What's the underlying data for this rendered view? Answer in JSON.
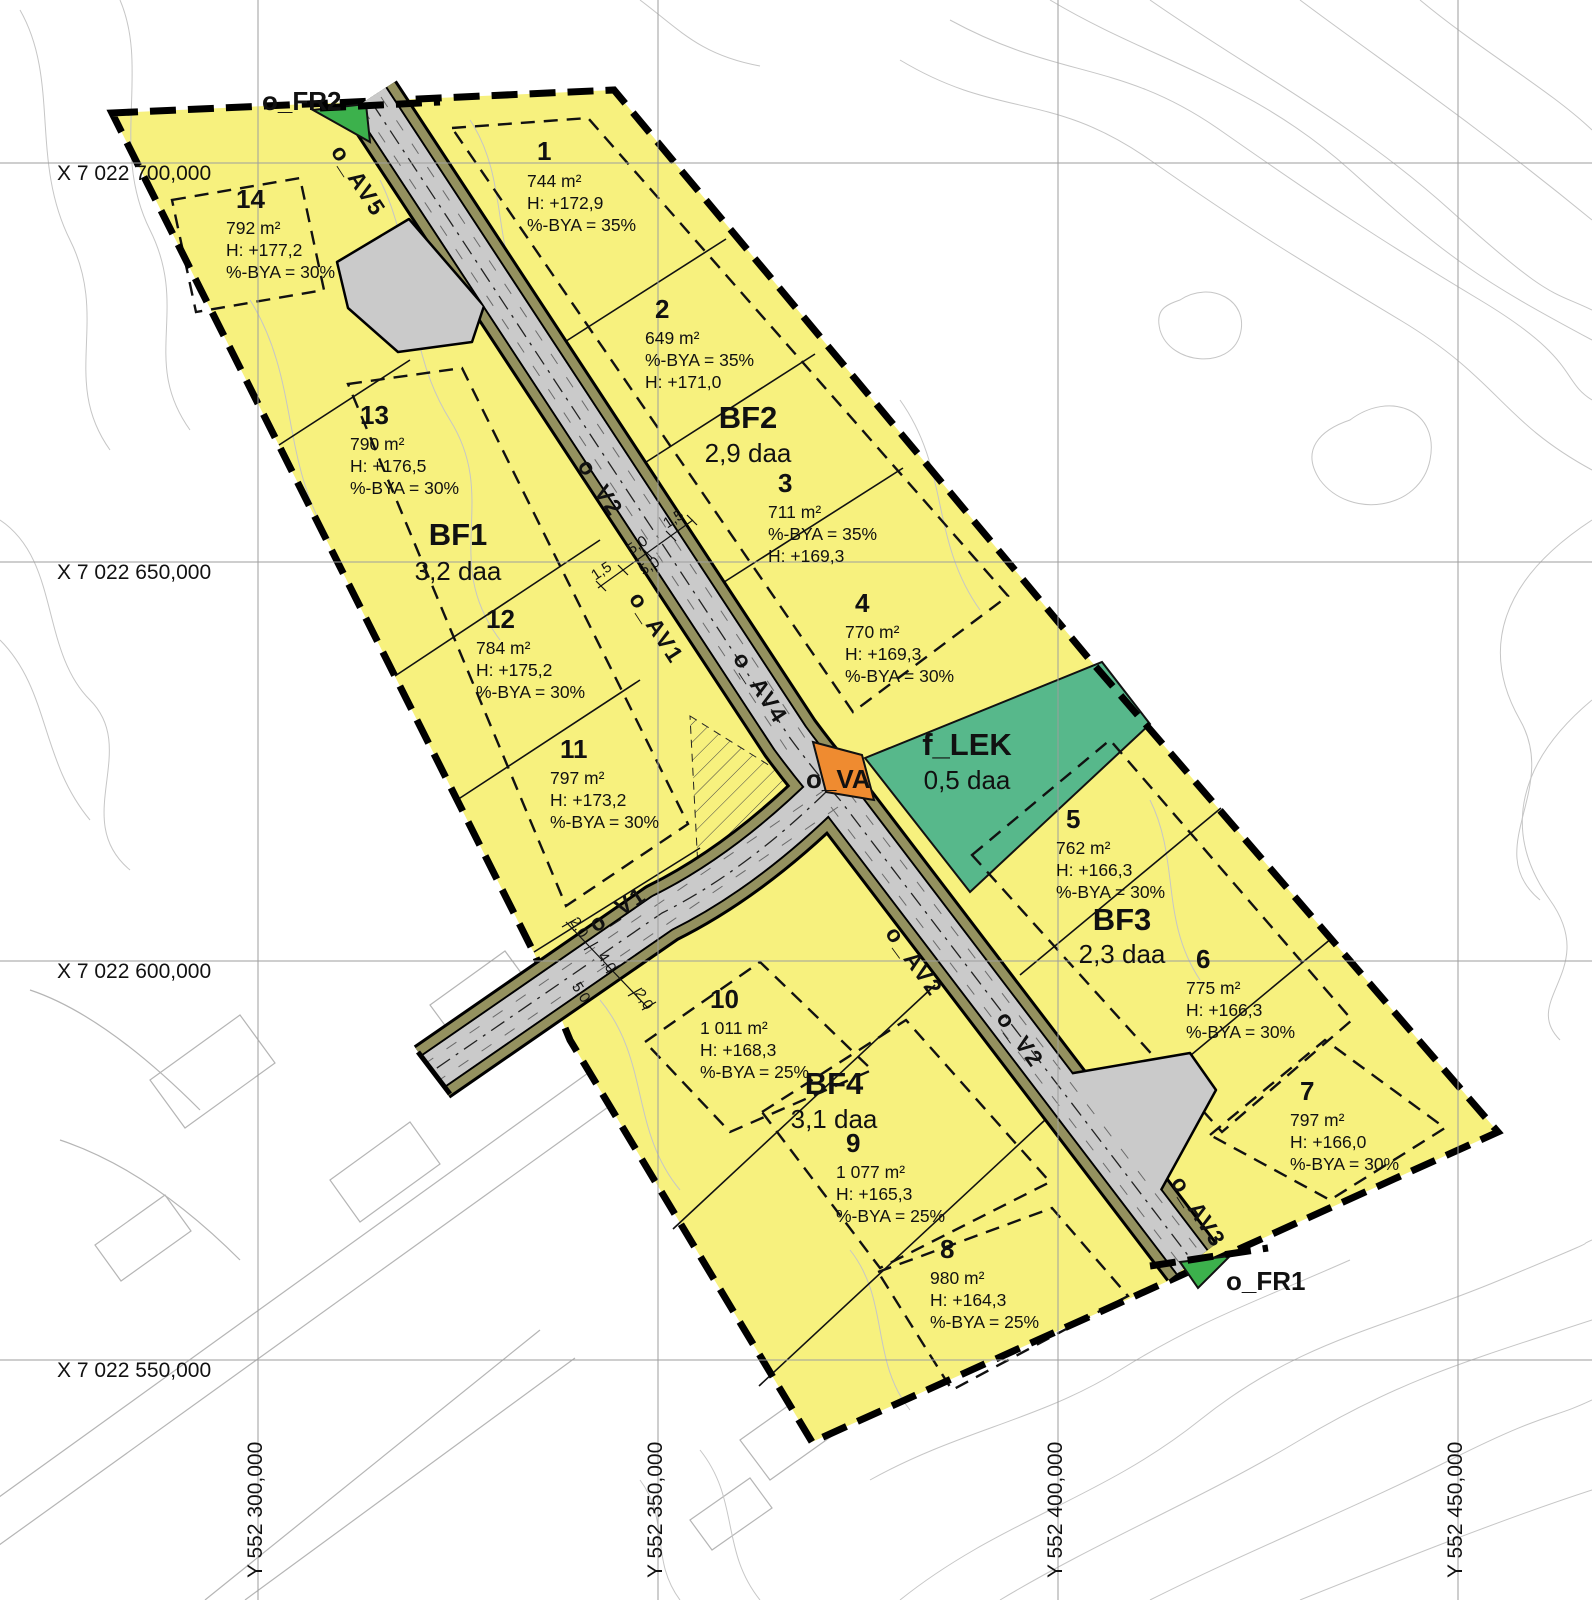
{
  "grid": {
    "x_labels": [
      "X 7 022 700,000",
      "X 7 022 650,000",
      "X 7 022 600,000",
      "X 7 022 550,000"
    ],
    "y_labels": [
      "Y 552 300,000",
      "Y 552 350,000",
      "Y 552 400,000",
      "Y 552 450,000"
    ]
  },
  "zones": [
    {
      "id": "BF1",
      "size": "3,2 daa"
    },
    {
      "id": "BF2",
      "size": "2,9 daa"
    },
    {
      "id": "BF3",
      "size": "2,3 daa"
    },
    {
      "id": "BF4",
      "size": "3,1 daa"
    },
    {
      "id": "f_LEK",
      "size": "0,5 daa"
    }
  ],
  "plots": [
    {
      "num": "1",
      "lines": [
        "744 m²",
        "H: +172,9",
        "%-BYA = 35%"
      ]
    },
    {
      "num": "2",
      "lines": [
        "649 m²",
        "%-BYA = 35%",
        "H: +171,0"
      ]
    },
    {
      "num": "3",
      "lines": [
        "711 m²",
        "%-BYA = 35%",
        "H: +169,3"
      ]
    },
    {
      "num": "4",
      "lines": [
        "770 m²",
        "H: +169,3",
        "%-BYA = 30%"
      ]
    },
    {
      "num": "5",
      "lines": [
        "762 m²",
        "H: +166,3",
        "%-BYA = 30%"
      ]
    },
    {
      "num": "6",
      "lines": [
        "775 m²",
        "H: +166,3",
        "%-BYA = 30%"
      ]
    },
    {
      "num": "7",
      "lines": [
        "797 m²",
        "H: +166,0",
        "%-BYA = 30%"
      ]
    },
    {
      "num": "8",
      "lines": [
        "980 m²",
        "H: +164,3",
        "%-BYA = 25%"
      ]
    },
    {
      "num": "9",
      "lines": [
        "1 077 m²",
        "H: +165,3",
        "%-BYA = 25%"
      ]
    },
    {
      "num": "10",
      "lines": [
        "1 011 m²",
        "H: +168,3",
        "%-BYA = 25%"
      ]
    },
    {
      "num": "11",
      "lines": [
        "797 m²",
        "H: +173,2",
        "%-BYA = 30%"
      ]
    },
    {
      "num": "12",
      "lines": [
        "784 m²",
        "H: +175,2",
        "%-BYA = 30%"
      ]
    },
    {
      "num": "13",
      "lines": [
        "790 m²",
        "H: +176,5",
        "%-BYA = 30%"
      ]
    },
    {
      "num": "14",
      "lines": [
        "792 m²",
        "H: +177,2",
        "%-BYA = 30%"
      ]
    }
  ],
  "roads": {
    "v1": "o_V1",
    "v2": "o_V2",
    "av1": "o_AV1",
    "av2": "o_AV2",
    "av3": "o_AV3",
    "av4": "o_AV4",
    "av5": "o_AV5",
    "va": "o_VA",
    "fr1": "o_FR1",
    "fr2": "o_FR2"
  },
  "dimensions": {
    "v2_section": [
      "1,5",
      "5,0",
      "5,0",
      "1,5"
    ],
    "v1_section": [
      "2,0",
      "4,0",
      "5,0",
      "2,0"
    ]
  },
  "colors": {
    "residential_yellow": "#f7f17e",
    "play_area_green": "#57b88b",
    "fr_green": "#3cb14c",
    "va_orange": "#ef8b30",
    "road_gray": "#cacaca",
    "verge_olive": "#94915f"
  }
}
